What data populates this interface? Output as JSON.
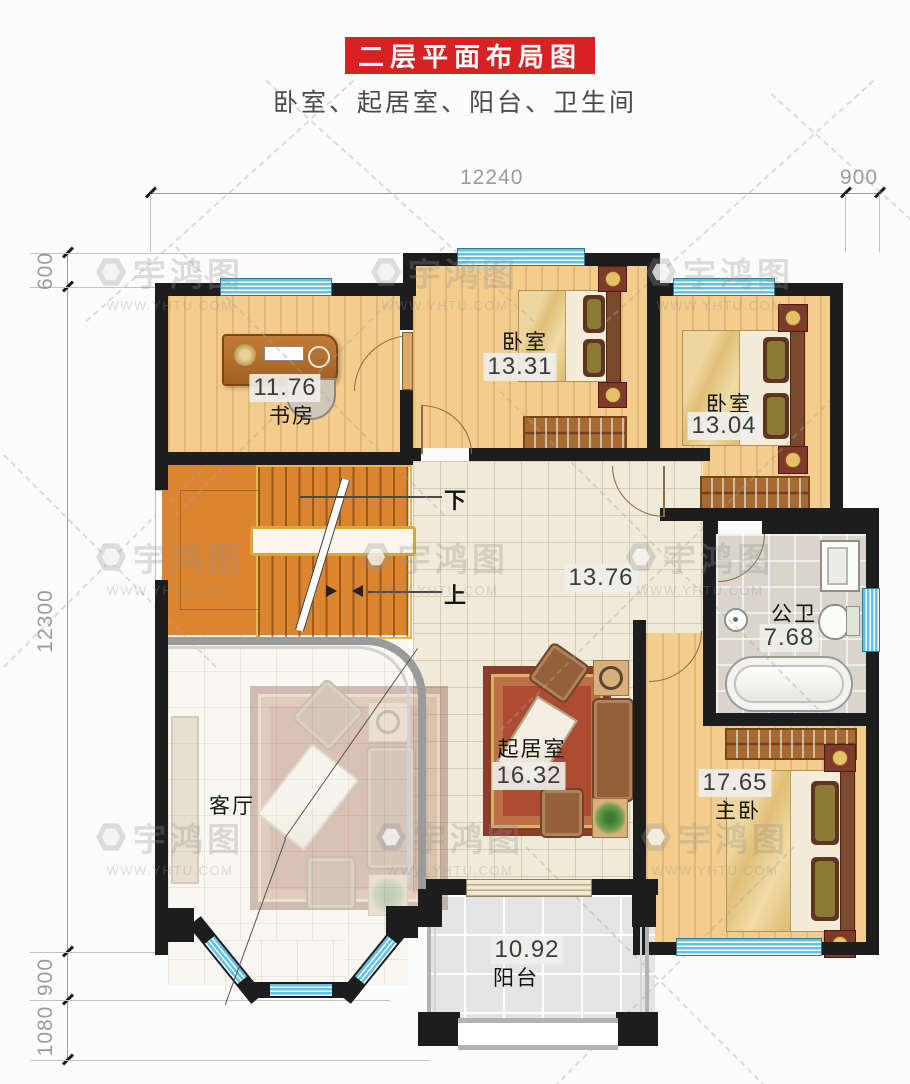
{
  "header": {
    "title": "二层平面布局图",
    "subtitle": "卧室、起居室、阳台、卫生间"
  },
  "dimensions": {
    "top_width": "12240",
    "top_right": "900",
    "left_top": "600",
    "left_main": "12300",
    "left_lower": "900",
    "left_bottom": "1080"
  },
  "rooms": {
    "study": {
      "name": "书房",
      "area": "11.76"
    },
    "bedroom1": {
      "name": "卧室",
      "area": "13.31"
    },
    "bedroom2": {
      "name": "卧室",
      "area": "13.04"
    },
    "hallway": {
      "area": "13.76"
    },
    "bathroom": {
      "name": "公卫",
      "area": "7.68"
    },
    "living": {
      "name": "客厅"
    },
    "sitting": {
      "name": "起居室",
      "area": "16.32"
    },
    "master": {
      "name": "主卧",
      "area": "17.65"
    },
    "balcony": {
      "name": "阳台",
      "area": "10.92"
    }
  },
  "stairs": {
    "down_label": "下",
    "up_label": "上"
  },
  "watermark": {
    "brand": "宇鸿图",
    "site": "WWW.YHTU.COM"
  },
  "colors": {
    "accent_red": "#d62222",
    "wall": "#1d1d1d",
    "window_cyan": "#5fc2e6",
    "stairs_orange": "#db8531"
  }
}
